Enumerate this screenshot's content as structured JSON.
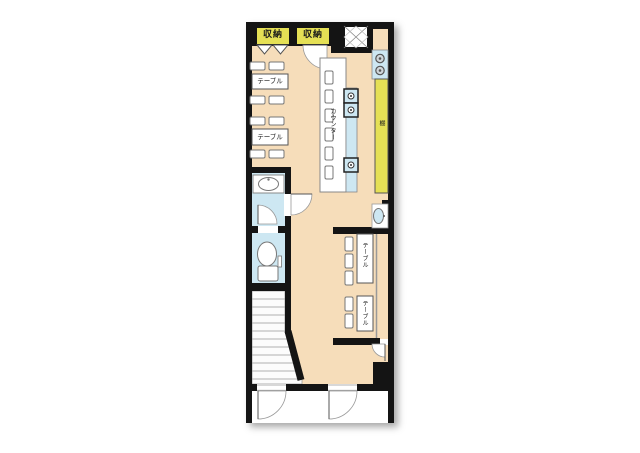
{
  "plan": {
    "type": "floor-plan",
    "colors": {
      "floor": "#f6ddba",
      "storage": "#e5e055",
      "water": "#cde7f2",
      "wall": "#141414"
    },
    "labels": {
      "storage_left": "収納",
      "storage_right": "収納",
      "table_left_1": "テーブル",
      "table_left_2": "テーブル",
      "counter": "カウンター",
      "shelf": "棚",
      "table_right_1": "テーブル",
      "table_right_2": "テーブル"
    }
  }
}
